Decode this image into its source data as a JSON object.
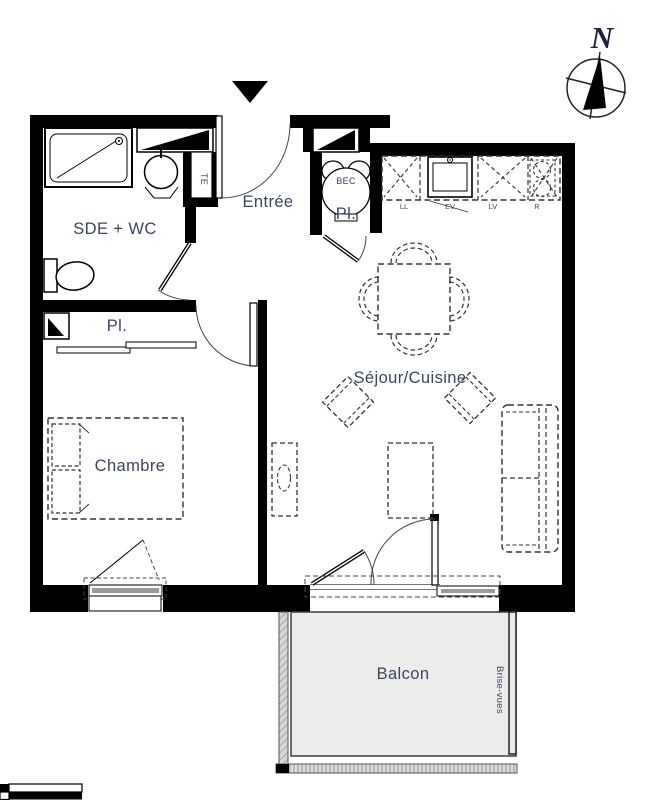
{
  "colors": {
    "wall": "#000000",
    "label": "#39465e",
    "balcony_floor": "#ececec"
  },
  "compass": {
    "north_label": "N"
  },
  "rooms": {
    "entree": {
      "label": "Entrée"
    },
    "sde_wc": {
      "label": "SDE + WC"
    },
    "closet_bedroom": {
      "label": "Pl."
    },
    "closet_water_heater": {
      "label": "Pl."
    },
    "sejour_cuisine": {
      "label": "Séjour/Cuisine"
    },
    "chambre": {
      "label": "Chambre"
    },
    "balcon": {
      "label": "Balcon"
    }
  },
  "equipment": {
    "water_heater_label": "BEC",
    "electrical_panel_label": "TE",
    "privacy_screen_label": "Brise-vues",
    "kitchen_unit_labels": [
      "LL",
      "EV",
      "LV",
      "R"
    ]
  }
}
